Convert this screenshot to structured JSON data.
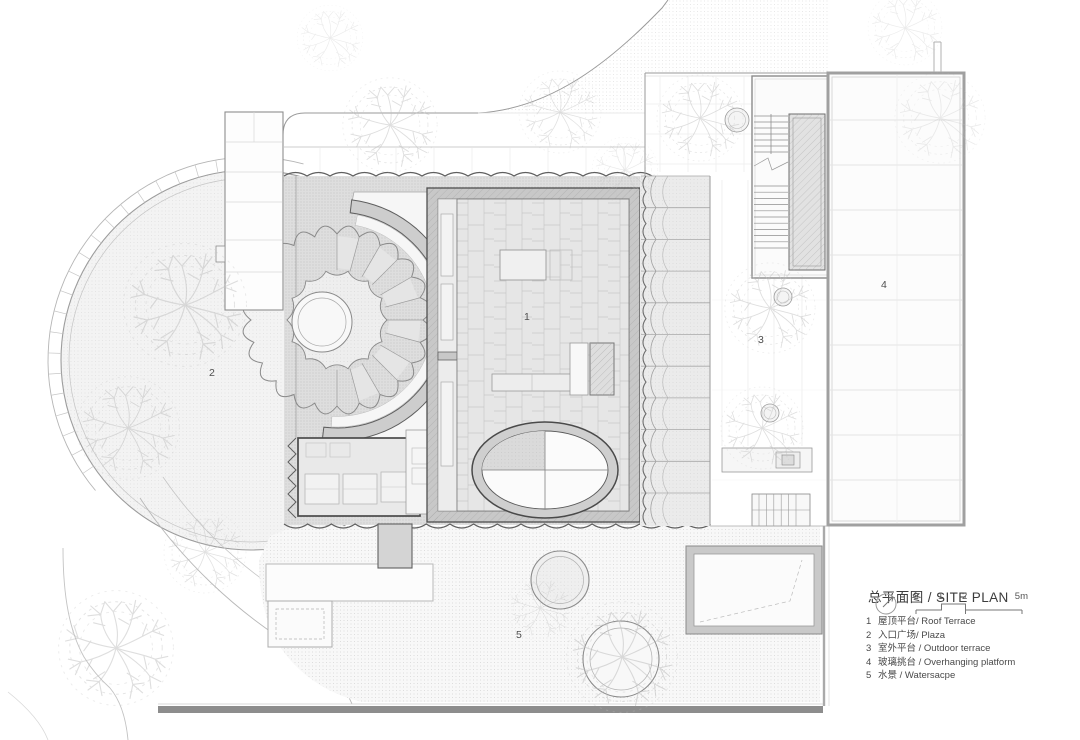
{
  "title": {
    "text": "总平面图 / SITE PLAN"
  },
  "scale_bar": {
    "labels": [
      "0",
      "1",
      "2",
      "5m"
    ]
  },
  "legend_items": [
    {
      "num": "1",
      "label": "屋顶平台/ Roof Terrace"
    },
    {
      "num": "2",
      "label": "入口广场/ Plaza"
    },
    {
      "num": "3",
      "label": "室外平台 / Outdoor terrace"
    },
    {
      "num": "4",
      "label": "玻璃挑台 / Overhanging platform"
    },
    {
      "num": "5",
      "label": "水景 / Watersacpe"
    }
  ],
  "plan_labels": {
    "roof_terrace": "1",
    "plaza": "2",
    "outdoor_terrace": "3",
    "overhanging_platform": "4",
    "waterscape": "5"
  },
  "colors": {
    "paper": "#ffffff",
    "line_dark": "#5a5a5a",
    "line_mid": "#999999",
    "hatch_fill": "#dcdcdc",
    "wall_fill": "#c8c8c8",
    "bottom_bar": "#8d8d8d"
  }
}
